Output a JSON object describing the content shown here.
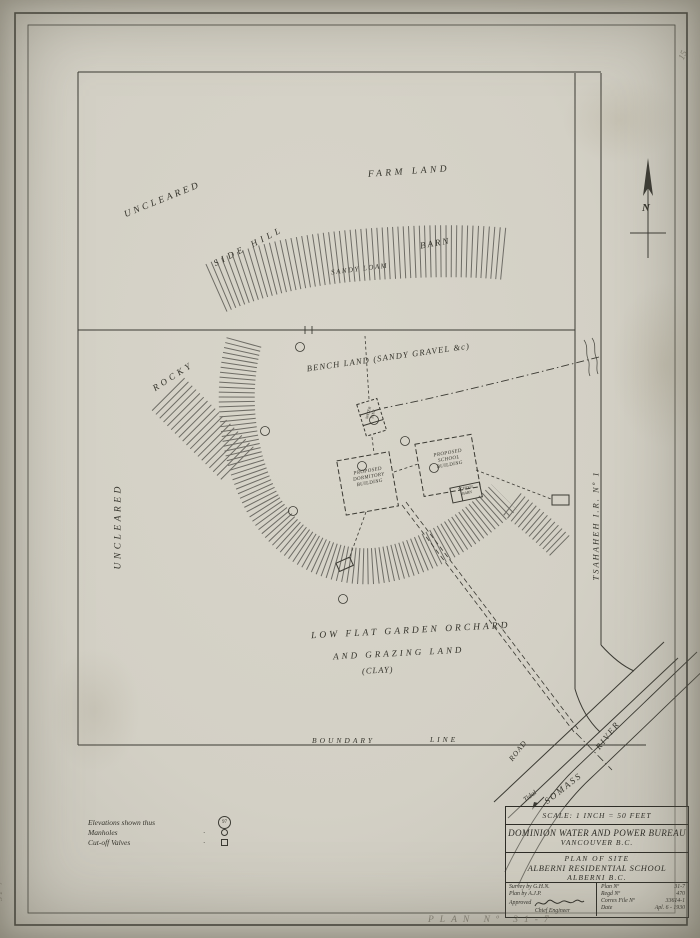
{
  "page": {
    "pencil_top_right": "15",
    "pencil_left_margin": "31 7",
    "pencil_bottom": "PLAN Nº 31-7"
  },
  "north": {
    "label": "N"
  },
  "map": {
    "labels": {
      "farm_land": "FARM LAND",
      "uncleared_top": "UNCLEARED",
      "side_hill": "SIDE HILL",
      "barn": "BARN",
      "sandy_loam": "SANDY LOAM",
      "rocky": "ROCKY",
      "bench_land": "BENCH LAND (SANDY GRAVEL &c)",
      "uncleared_left": "UNCLEARED",
      "low_flat_1": "LOW FLAT GARDEN ORCHARD",
      "low_flat_2": "AND GRAZING LAND",
      "low_flat_3": "(CLAY)",
      "boundary_word": "BOUNDARY",
      "line_word": "LINE",
      "tsahaheh": "TSAHAHEH  I.R. Nº 1",
      "road": "ROAD",
      "somass": "SOMASS",
      "river": "RIVER",
      "tidal": "Tidal"
    },
    "buildings": {
      "dormitory": {
        "l1": "PROPOSED",
        "l2": "DORMITORY",
        "l3": "BUILDING"
      },
      "school": {
        "l1": "PROPOSED",
        "l2": "SCHOOL",
        "l3": "BUILDING"
      },
      "school_barn": {
        "l1": "SCHOOL",
        "l2": "BARN"
      },
      "water_tank": {
        "l1": "WATER",
        "l2": "TANK"
      }
    }
  },
  "legend": {
    "rows": [
      {
        "label": "Elevations shown thus",
        "sample": "97"
      },
      {
        "label": "Manholes",
        "leader": "·"
      },
      {
        "label": "Cut-off Valves",
        "leader": "·"
      }
    ]
  },
  "title_block": {
    "scale": "SCALE: 1 INCH = 50 FEET",
    "org": "DOMINION WATER AND POWER BUREAU",
    "org_city": "VANCOUVER B.C.",
    "plan_title_1": "PLAN OF SITE",
    "plan_title_2": "ALBERNI RESIDENTIAL SCHOOL",
    "plan_title_3": "ALBERNI B.C.",
    "survey_by": "Survey by G.H.N.",
    "plan_by": "Plan by A.J.P.",
    "approved": "Approved",
    "chief": "Chief Engineer",
    "plan_no_label": "Plan Nº",
    "plan_no": "31-7",
    "regd_label": "Regd Nº",
    "regd_no": "470",
    "file_label": "Corres File Nº",
    "file_no": "33614-1",
    "date_label": "Date",
    "date": "Apl. 6 - 1930"
  },
  "colors": {
    "ink": "#3b3a33",
    "paper": "#d6d3c8",
    "pencil": "#8a877c"
  }
}
